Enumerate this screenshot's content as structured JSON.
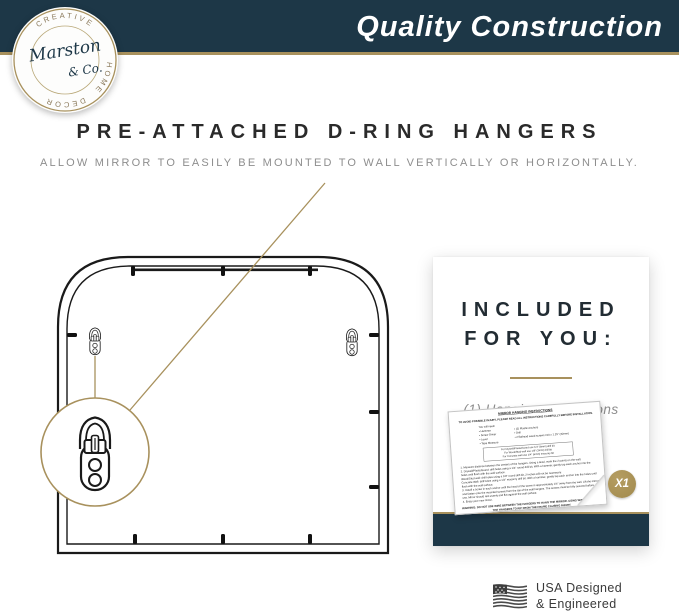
{
  "colors": {
    "navy": "#1d3747",
    "gold": "#a8915d",
    "badge_gold": "#a18a4e",
    "ink": "#1a1a1a",
    "title_dark": "#2a2a2a",
    "gray": "#8e8e8e",
    "flag_gray": "#474747",
    "card_gray": "#8d8d8d"
  },
  "header": {
    "title": "Quality Construction"
  },
  "logo": {
    "ring_top": "CREATIVE",
    "ring_right": "HOME",
    "ring_bottom": "DECOR",
    "script_line1": "Marston",
    "script_line2": "& Co."
  },
  "headline": {
    "title": "PRE-ATTACHED D-RING HANGERS",
    "subtitle": "ALLOW MIRROR TO EASILY BE MOUNTED TO WALL VERTICALLY OR HORIZONTALLY."
  },
  "included_card": {
    "title_line1": "INCLUDED",
    "title_line2": "FOR YOU:",
    "item": "(1) Hanging Instructions",
    "badge": "X1",
    "sheet": {
      "title": "MIRROR HANGING INSTRUCTIONS",
      "caution": "TO AVOID POSSIBLE INJURY, PLEASE READ ALL INSTRUCTIONS CAREFULLY BEFORE INSTALLATION.",
      "need_label": "You will need:",
      "need_left": [
        "• Hammer",
        "• Screw Driver",
        "• Level",
        "• Tape Measure"
      ],
      "need_right": [
        "• (2) Plastic Anchors",
        "• Drill",
        "• 2 flathead wood screws #10 x 1.25\" (32mm)"
      ],
      "note_lines": [
        "For Drywall/Plasterboard use 1/4\" (6mm) drill bit",
        "For Wood/Stud wall use 1/8\" (3mm) drill bit",
        "For Concrete wall use 1/4\" (6mm) masonry bit"
      ],
      "steps": [
        "1.  Measure distance between the centers of the hangers. Using a level, mark the 2 points on the wall.",
        "2.  Drywall/Plasterboard: drill holes using a 1/4\" round drill bit. With a hammer, gently tap each anchor into the holes until flush with the wall surface.",
        "     Wood/Stud wall: drill holes using a 1/8\" round drill bit, 2 inches will not be necessary.",
        "     Concrete Wall: drill holes using a 1/4\" masonry drill bit. With a hammer, gently tap each anchor into the holes until flush with the wall surface.",
        "3.  Install a screw in each anchor until the head of the screw is approximately 1/4\" away from the wall. Lift the mirror and fasten onto the mounted screws from the top of the wall hangers. The screws must be fully secured before use. Mirror should rest evenly and flat against the wall surface.",
        "4.  Enjoy your new mirror."
      ],
      "warning": "WARNING: DO NOT USE WIRE BETWEEN THE HANGERS TO HANG THE MIRROR. USING WIRE MAY CAUSE THE HANGERS TO RIP FROM THE FRAME CAUSING INJURY."
    }
  },
  "footer": {
    "usa_line1": "USA Designed",
    "usa_line2": "& Engineered"
  }
}
